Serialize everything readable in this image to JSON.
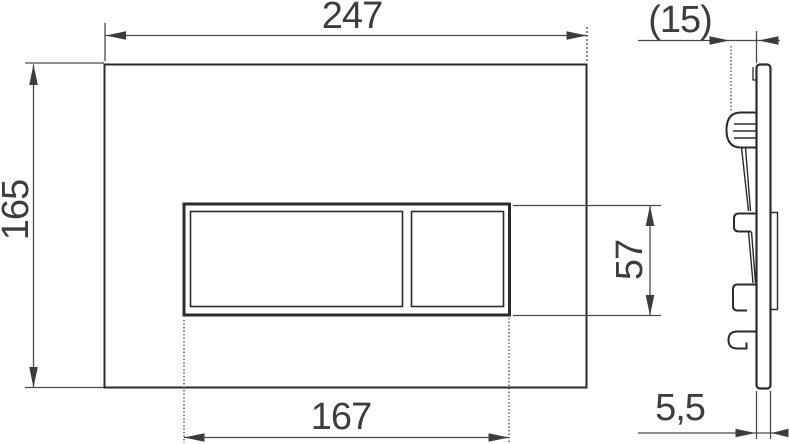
{
  "drawing": {
    "kind": "technical-dimension-drawing",
    "views": {
      "front": "flush-plate-front-view",
      "side": "flush-plate-side-profile"
    },
    "dimensions": {
      "overall_width": "247",
      "overall_height": "165",
      "button_area_width": "167",
      "button_area_height": "57",
      "installation_depth": "(15)",
      "plate_thickness": "5,5"
    },
    "colors": {
      "outline": "#2b2b2b",
      "dimension_line": "#4a4a4a",
      "arrowhead": "#3c3c3c",
      "label_text": "#3d3d3d",
      "background": "#ffffff"
    }
  }
}
